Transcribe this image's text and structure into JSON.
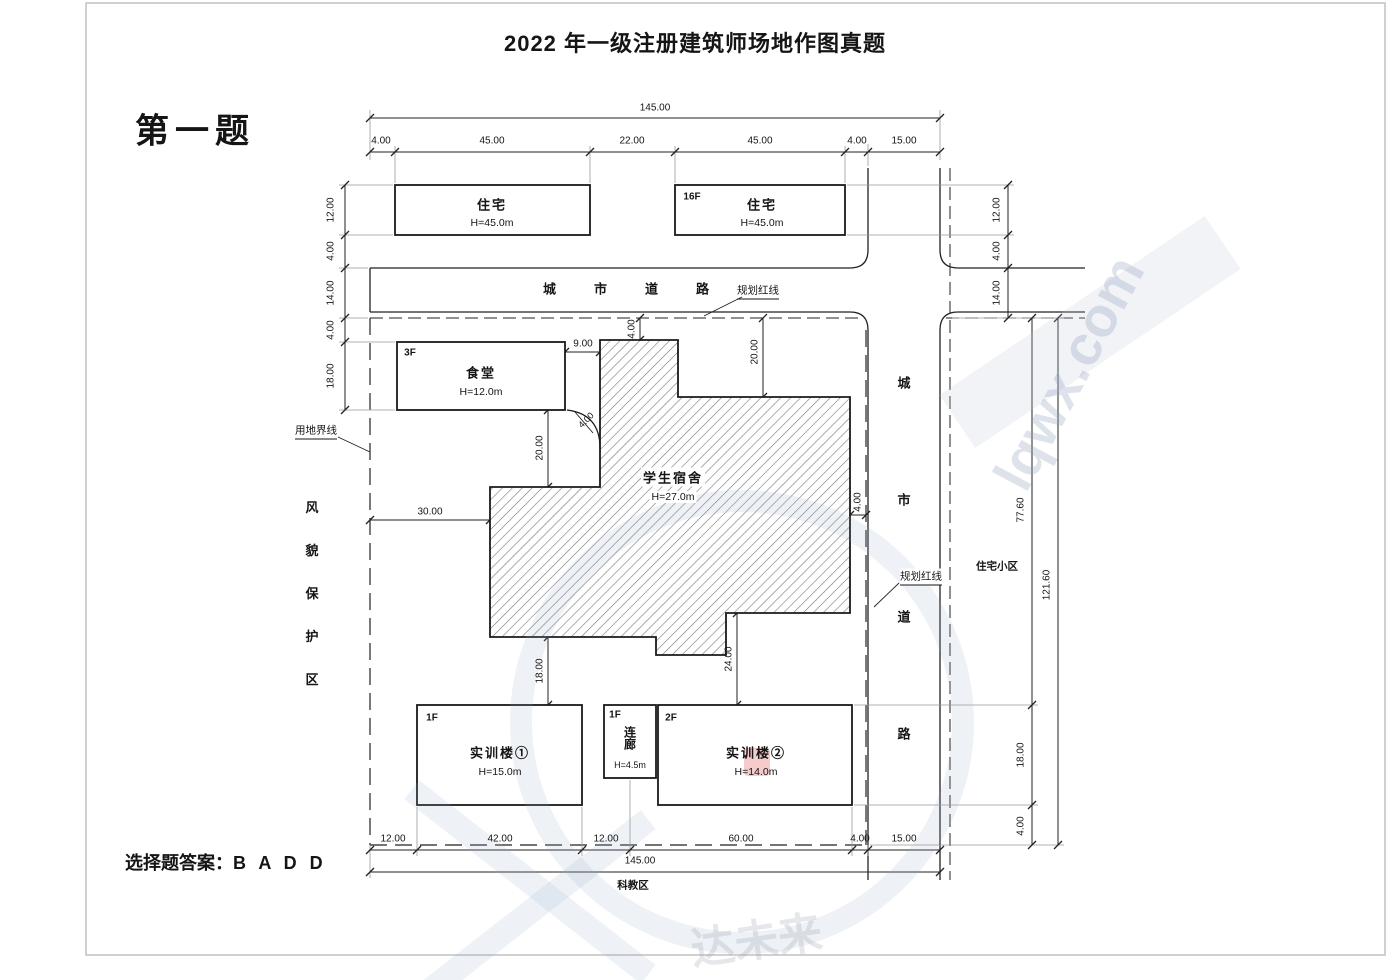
{
  "header": {
    "title": "2022 年一级注册建筑师场地作图真题",
    "question_label": "第一题",
    "answer_label": "选择题答案：B A D D"
  },
  "roads": {
    "top_name": "城市道路",
    "right_name": "城市道路",
    "planning_red_line_top": "规划红线",
    "planning_red_line_right": "规划红线",
    "site_boundary_label": "用地界线"
  },
  "areas": {
    "west": "风貌保护区",
    "east": "住宅小区",
    "south": "科教区"
  },
  "buildings": {
    "residential_left": {
      "name": "住宅",
      "height": "H=45.0m"
    },
    "residential_right": {
      "name": "住宅",
      "height": "H=45.0m",
      "floors": "16F"
    },
    "canteen": {
      "name": "食堂",
      "height": "H=12.0m",
      "floors": "3F"
    },
    "dormitory": {
      "name": "学生宿舍",
      "height": "H=27.0m"
    },
    "training_left": {
      "name": "实训楼①",
      "height": "H=15.0m",
      "floors": "1F"
    },
    "corridor": {
      "name": "连廊",
      "height": "H=4.5m",
      "floors": "1F"
    },
    "training_right": {
      "name": "实训楼②",
      "height": "H=14.0m",
      "floors": "2F"
    }
  },
  "dims": {
    "top_total": "145.00",
    "top_segments": [
      "4.00",
      "45.00",
      "22.00",
      "45.00",
      "4.00",
      "15.00"
    ],
    "bottom_segments": [
      "12.00",
      "42.00",
      "12.00",
      "60.00",
      "4.00",
      "15.00"
    ],
    "bottom_total": "145.00",
    "left_chain": [
      "12.00",
      "4.00",
      "14.00",
      "4.00",
      "18.00"
    ],
    "right_top_chain": [
      "12.00",
      "4.00",
      "14.00"
    ],
    "right_inner_chain": [
      "77.60",
      "18.00",
      "4.00"
    ],
    "right_outer_total": "121.60",
    "inner": {
      "canteen_gap": "9.00",
      "column_setback": "4.00",
      "main_setback": "20.00",
      "west_gap": "30.00",
      "canteen_vert_gap": "20.00",
      "east_gap": "4.00",
      "south_gap_left": "18.00",
      "south_gap_right": "24.00",
      "corner_gap": "4.00"
    }
  },
  "watermark": {
    "site_text": "lqwx.com",
    "ghost_text": "达未来"
  }
}
